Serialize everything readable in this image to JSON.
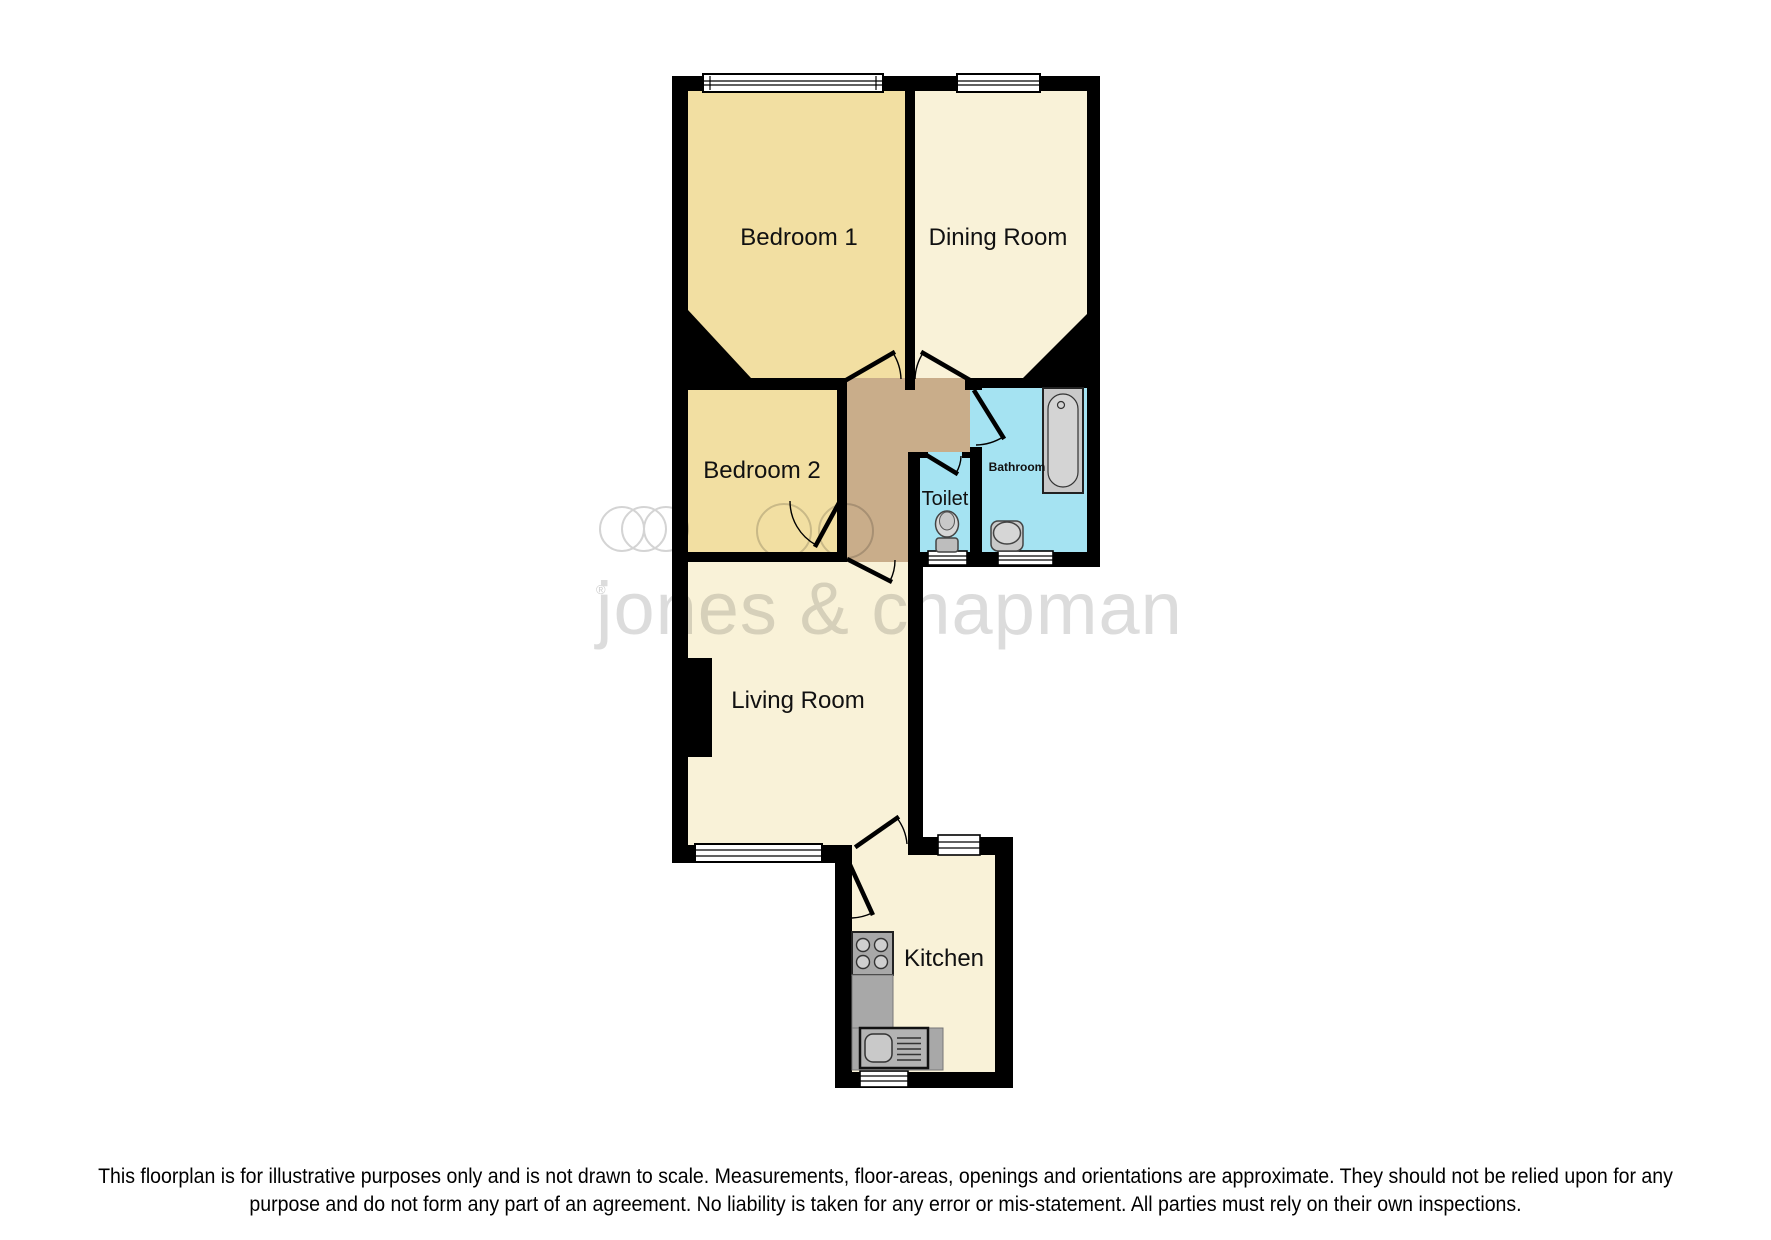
{
  "watermark": {
    "brand": "jones & chapman",
    "registered_mark": "®"
  },
  "rooms": {
    "bedroom1": "Bedroom 1",
    "dining": "Dining Room",
    "bedroom2": "Bedroom 2",
    "toilet": "Toilet",
    "bathroom": "Bathroom",
    "living": "Living Room",
    "kitchen": "Kitchen"
  },
  "disclaimer": {
    "line1": "This floorplan is for illustrative purposes only and is not drawn to scale. Measurements, floor-areas, openings and orientations are approximate. They should not be relied upon for any",
    "line2": "purpose and do not form any part of an agreement. No liability is taken for any error or mis-statement. All parties must rely on their own inspections."
  },
  "colors": {
    "wall": "#000000",
    "bedroom_floor": "#F2DFA2",
    "cream_floor": "#F9F2D8",
    "hallway_floor": "#C9AD8A",
    "bath_floor": "#A5E3F2",
    "fixture_fill": "#C9C9C9",
    "fixture_dark": "#A8A8A8",
    "window_fill": "#FFFFFF",
    "watermark_gray": "#DCDCDC"
  }
}
